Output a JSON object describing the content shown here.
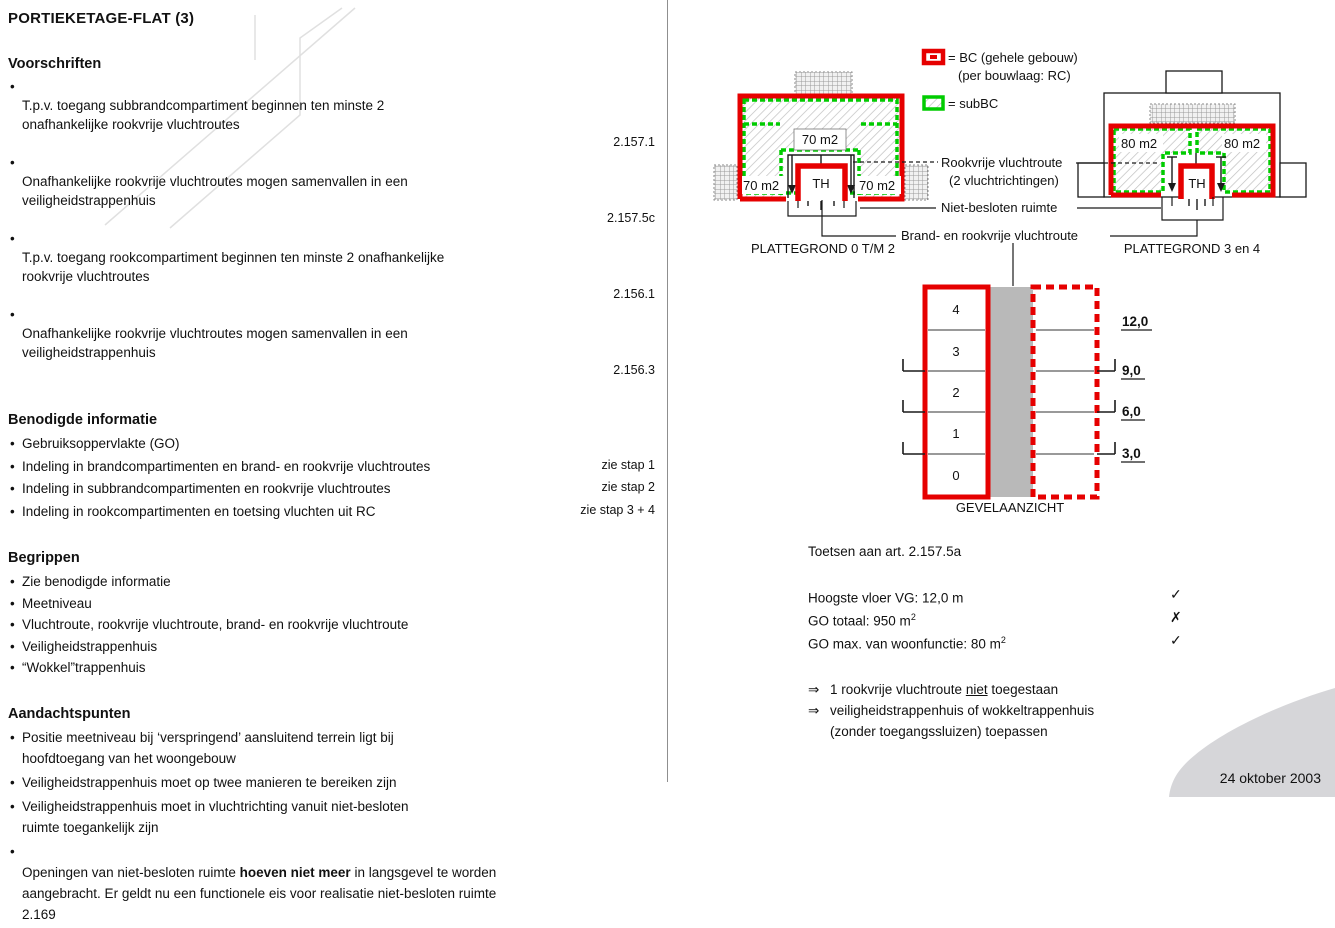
{
  "page": {
    "title": "PORTIEKETAGE-FLAT (3)",
    "date": "24 oktober 2003"
  },
  "sections": [
    {
      "heading": "Voorschriften",
      "items": [
        {
          "text": "T.p.v. toegang subbrandcompartiment beginnen ten minste 2\nonafhankelijke rookvrije vluchtroutes",
          "ref": "2.157.1"
        },
        {
          "text": "Onafhankelijke rookvrije vluchtroutes mogen samenvallen in een\nveiligheidstrappenhuis",
          "ref": "2.157.5c"
        },
        {
          "text": "T.p.v. toegang rookcompartiment beginnen ten minste 2 onafhankelijke\nrookvrije vluchtroutes",
          "ref": "2.156.1"
        },
        {
          "text": "Onafhankelijke rookvrije vluchtroutes mogen samenvallen in een\nveiligheidstrappenhuis",
          "ref": "2.156.3"
        }
      ]
    },
    {
      "heading": "Benodigde informatie",
      "items": [
        {
          "text": "Gebruiksoppervlakte (GO)",
          "ref": ""
        },
        {
          "text": "Indeling in brandcompartimenten en brand- en rookvrije vluchtroutes",
          "ref": "zie stap 1"
        },
        {
          "text": "Indeling in subbrandcompartimenten en rookvrije vluchtroutes",
          "ref": "zie stap 2"
        },
        {
          "text": "Indeling in rookcompartimenten en toetsing vluchten uit RC",
          "ref": "zie stap 3 + 4"
        }
      ]
    },
    {
      "heading": "Begrippen",
      "items": [
        {
          "text": "Zie benodigde informatie"
        },
        {
          "text": "Meetniveau"
        },
        {
          "text": "Vluchtroute, rookvrije vluchtroute, brand- en rookvrije vluchtroute"
        },
        {
          "text": "Veiligheidstrappenhuis"
        },
        {
          "text": "“Wokkel”trappenhuis"
        }
      ]
    },
    {
      "heading": "Aandachtspunten",
      "items": [
        {
          "text": "Positie meetniveau bij ‘verspringend’ aansluitend terrein ligt bij\nhoofdtoegang van het woongebouw"
        },
        {
          "text": "Veiligheidstrappenhuis moet op twee manieren te bereiken zijn"
        },
        {
          "text": "Veiligheidstrappenhuis moet in vluchtrichting vanuit niet-besloten\nruimte toegankelijk zijn"
        },
        {
          "pre": "Openingen van niet-besloten ruimte ",
          "bold": "hoeven niet meer",
          "post": " in langsgevel te worden\naangebracht. Er geldt nu een functionele eis voor realisatie niet-besloten ruimte\n2.169"
        }
      ]
    }
  ],
  "legend": {
    "bc_line1": "= BC (gehele gebouw)",
    "bc_line2": "(per bouwlaag: RC)",
    "subbc_line": "= subBC",
    "bc_color": "#e60000",
    "subbc_color": "#00cc00"
  },
  "plans": {
    "plan1": {
      "caption": "PLATTEGROND 0 T/M 2",
      "area_top": "70 m2",
      "area_left": "70 m2",
      "area_right": "70 m2",
      "stair": "TH"
    },
    "plan2": {
      "caption": "PLATTEGROND 3 en 4",
      "area_left": "80 m2",
      "area_right": "80 m2",
      "stair": "TH"
    },
    "callouts": {
      "smokefree_1": "Rookvrije vluchtroute",
      "smokefree_2": "(2 vluchtrichtingen)",
      "open_space": "Niet-besloten ruimte",
      "fire_smokefree": "Brand- en rookvrije vluchtroute"
    }
  },
  "elevation": {
    "caption": "GEVELAANZICHT",
    "floors": [
      "4",
      "3",
      "2",
      "1",
      "0"
    ],
    "heights": [
      "12,0",
      "9,0",
      "6,0",
      "3,0"
    ]
  },
  "assessment": {
    "intro": "Toetsen aan art. 2.157.5a",
    "rows": [
      {
        "label": "Hoogste vloer VG: 12,0 m",
        "sup": "",
        "mark": "✓"
      },
      {
        "label": "GO totaal: 950 m",
        "sup": "2",
        "mark": "✗"
      },
      {
        "label": "GO max. van woonfunctie: 80 m",
        "sup": "2",
        "mark": "✓"
      }
    ],
    "arrow": "⇒",
    "conclusions": [
      {
        "pre": "1 rookvrije vluchtroute ",
        "underline": "niet",
        "post": " toegestaan",
        "line2": ""
      },
      {
        "pre": "veiligheidstrappenhuis of wokkeltrappenhuis",
        "underline": "",
        "post": "",
        "line2": "(zonder toegangssluizen) toepassen"
      }
    ]
  }
}
